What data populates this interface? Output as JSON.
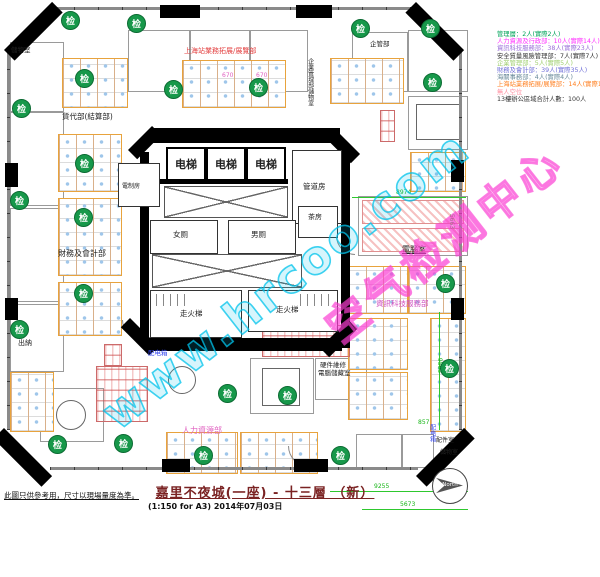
{
  "title": {
    "main": "嘉里不夜城(一座) - 十三層 （新）",
    "sub": "(1:150 for A3)  2014年07月03日"
  },
  "note": {
    "text": "此圖只供參考用，尺寸以現場量度為準。"
  },
  "watermark": {
    "site": "www.hrcoo.com",
    "stamp": "空气检测中心"
  },
  "marker": {
    "label": "检"
  },
  "compass": {
    "label": "North"
  },
  "legend": {
    "lines": [
      {
        "text": "管理層：2人(實際2人)",
        "color": "#00a35a"
      },
      {
        "text": "人力資源及行政部：10人(實際14人)",
        "color": "#ff30ff"
      },
      {
        "text": "資訊科技服務部：38人(實際23人)",
        "color": "#9a6fd8"
      },
      {
        "text": "安全質量風險管理部：7人(實際7人)",
        "color": "#333333"
      },
      {
        "text": "企業管理部：5人(實際5人)",
        "color": "#9fcf6f"
      },
      {
        "text": "財務及會計部：39人(實際35人)",
        "color": "#7070d8"
      },
      {
        "text": "海關事務部：4人(實際4人)",
        "color": "#6a8a9a"
      },
      {
        "text": "上海站業務拓展/展覽部：14人(實際10人)",
        "color": "#ff7f1f"
      },
      {
        "text": "無人空位",
        "color": "#ff8fa0"
      },
      {
        "text": "13樓辦公區域合計人數：100人",
        "color": "#333333"
      }
    ]
  },
  "core": {
    "elevator": "电梯",
    "electrical": "電制房",
    "pipe": "管道房",
    "female_toilet": "女厕",
    "male_toilet": "男厕",
    "tea": "茶房",
    "fire_stair": "走火梯"
  },
  "labels": {
    "storage_tl": "儲物室",
    "freight": "貨代部(結算部)",
    "shanghai_biz": "上海站業務拓展/展覽部",
    "corp": "企管部",
    "corp_storage": "企業管理部儲物室",
    "finance": "財務及會計部",
    "cashier": "出納",
    "hr": "人力資源部",
    "computer": "電腦室",
    "it": "資訊科技服務部",
    "hardware1": "硬件維修",
    "hardware2": "電腦儲藏室",
    "distbox": "配电箱",
    "storage_b": "儲物室",
    "parts": "配件室"
  },
  "dims": {
    "a": "8974",
    "b": "5663",
    "c": "9563",
    "d": "857",
    "e": "9255",
    "f": "5673",
    "g": "670"
  }
}
